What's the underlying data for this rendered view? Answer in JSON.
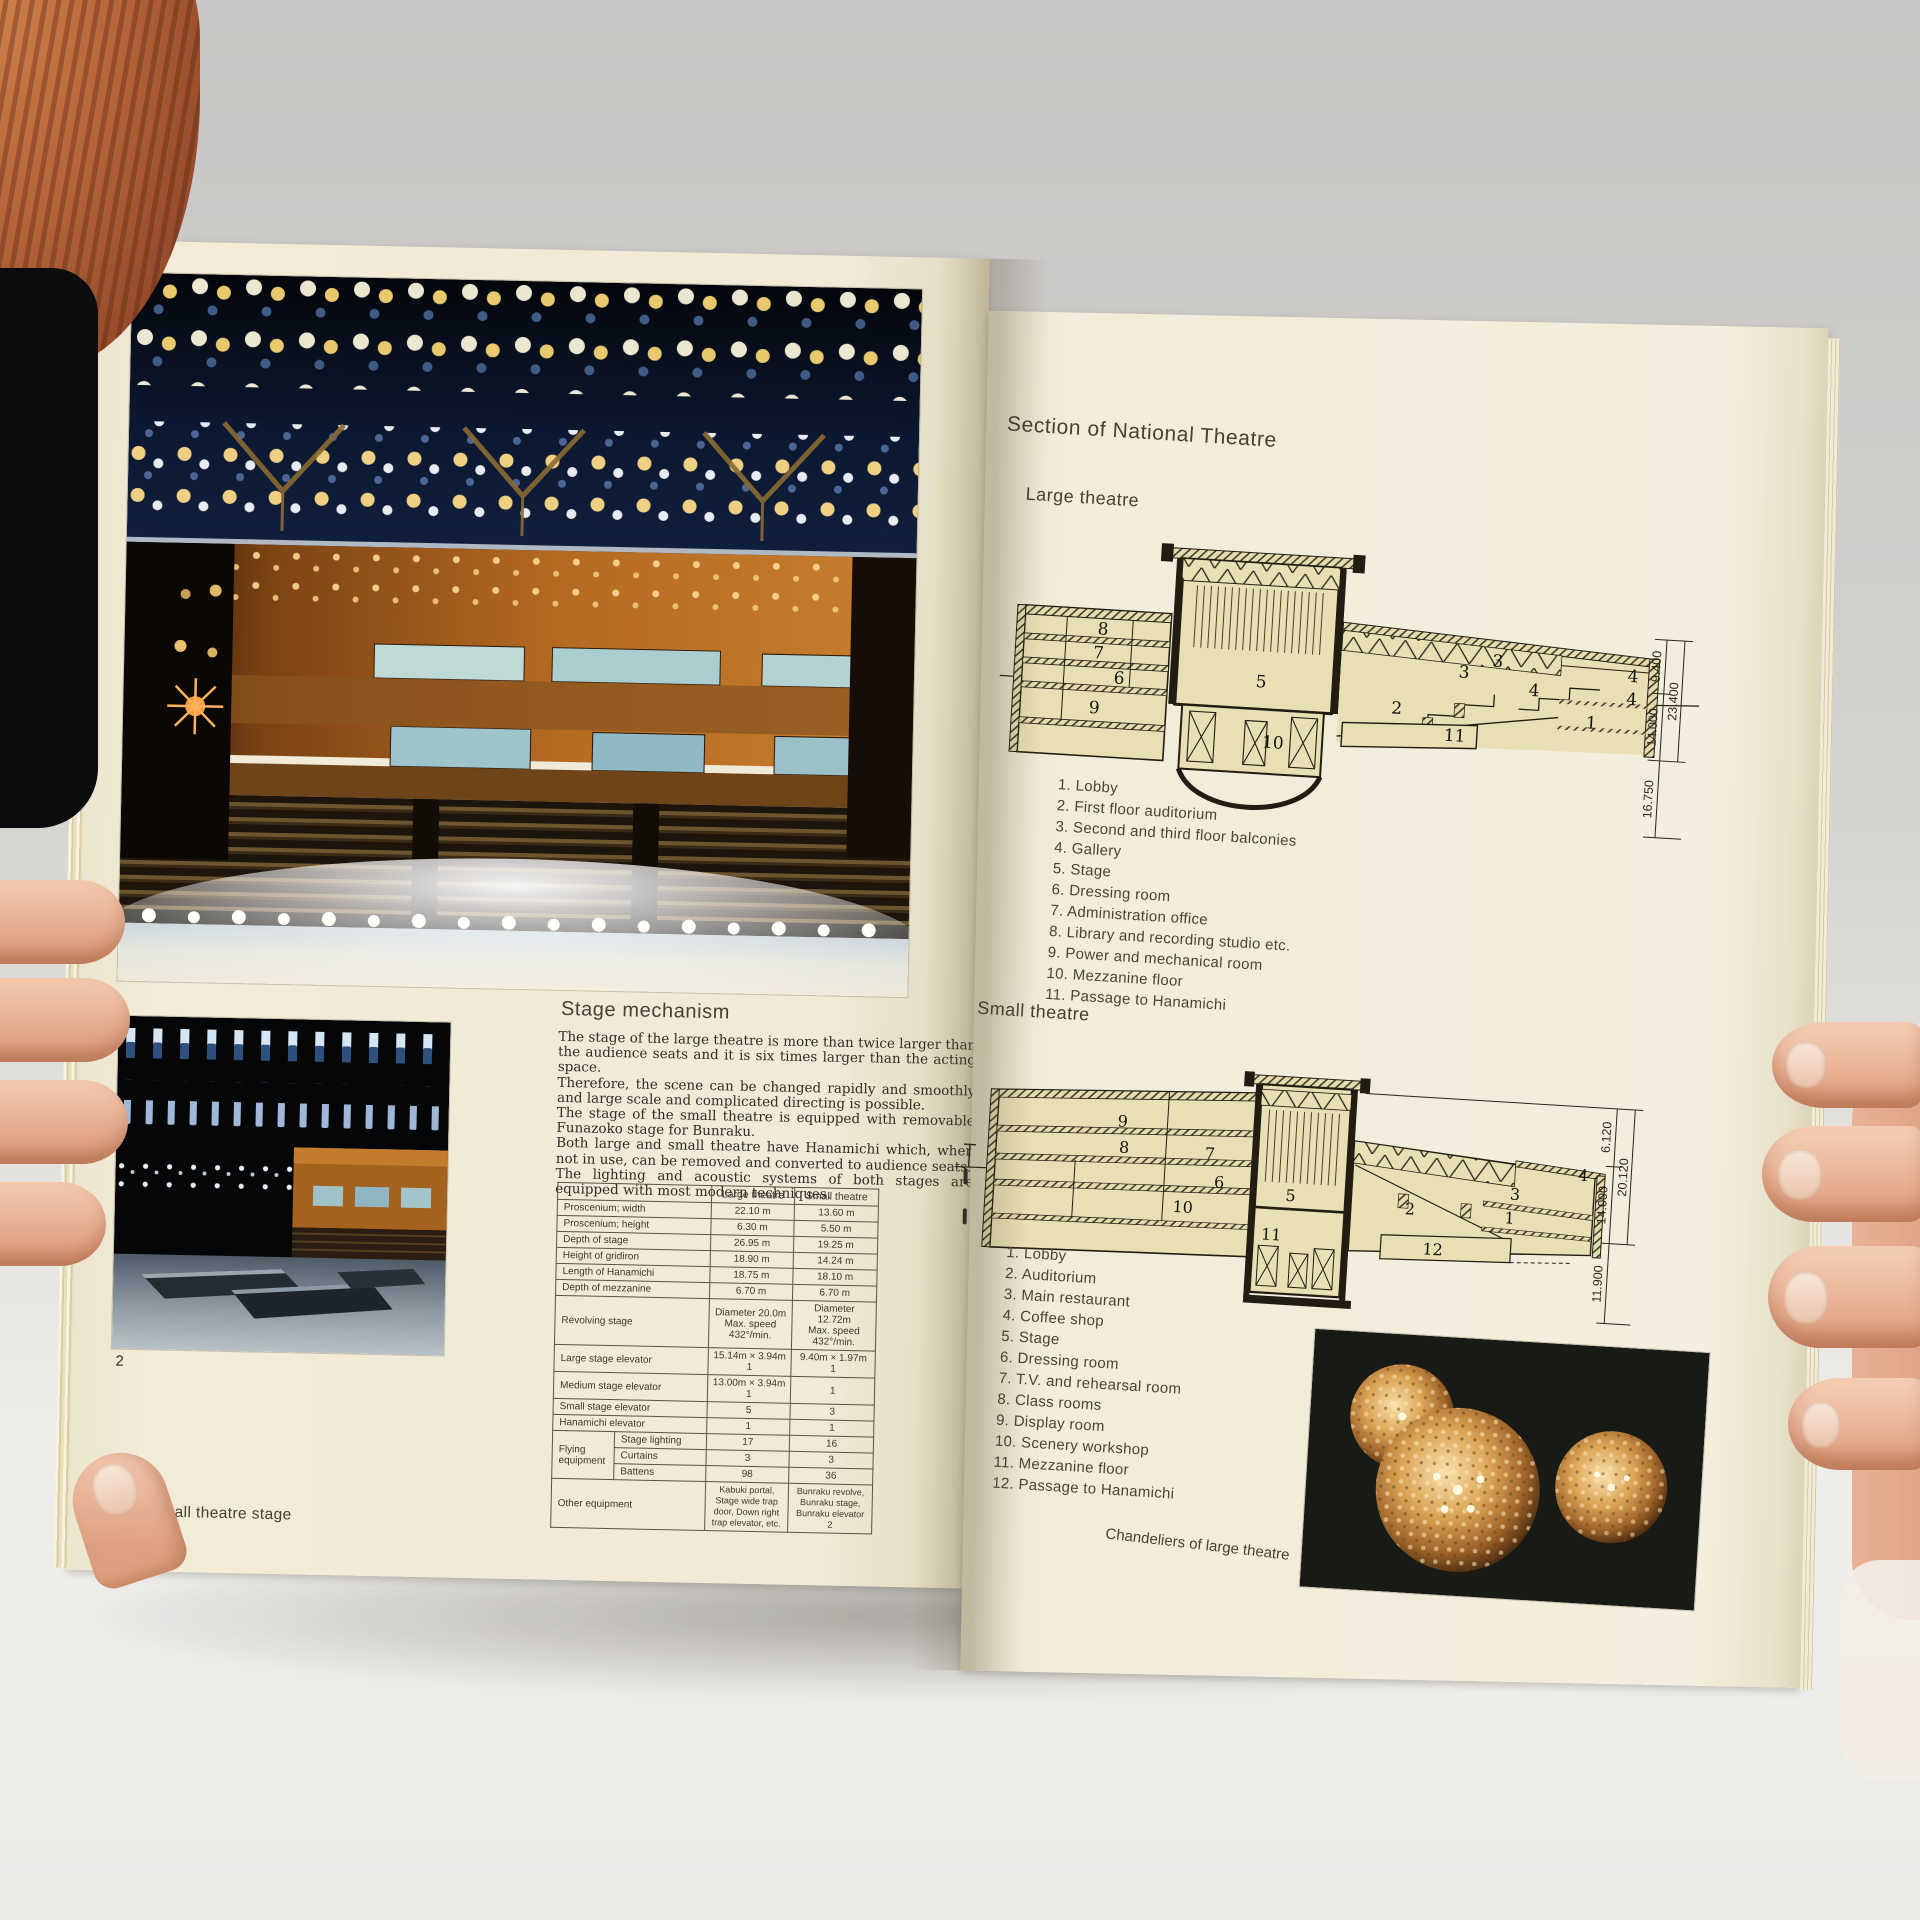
{
  "book": {
    "left_page": {
      "figure2_label": "2",
      "caption": "1.2. Small theatre stage",
      "stage_mechanism": {
        "heading": "Stage mechanism",
        "paragraphs": [
          "The stage of the large theatre is more than twice larger than the audience seats and it is six times larger than the acting space.",
          "Therefore, the scene can be changed rapidly and smoothly and large scale and complicated directing is possible.",
          "The stage of the small theatre is equipped with removable Funazoko stage for Bunraku.",
          "Both large and small theatre have Hanamichi which, when not in use, can be removed and converted to audience seats.",
          "The lighting and acoustic systems of both stages are equipped with most modern techniques."
        ]
      },
      "spec_table": {
        "col_large": "Large theatre",
        "col_small": "Small theatre",
        "rows": [
          {
            "label": "Proscenium; width",
            "large": "22.10 m",
            "small": "13.60 m"
          },
          {
            "label": "Proscenium; height",
            "large": "6.30 m",
            "small": "5.50 m"
          },
          {
            "label": "Depth of stage",
            "large": "26.95 m",
            "small": "19.25 m"
          },
          {
            "label": "Height of gridiron",
            "large": "18.90 m",
            "small": "14.24 m"
          },
          {
            "label": "Length of Hanamichi",
            "large": "18.75 m",
            "small": "18.10 m"
          },
          {
            "label": "Depth of mezzanine",
            "large": "6.70 m",
            "small": "6.70 m"
          },
          {
            "label": "Revolving stage",
            "large_l1": "Diameter 20.0m",
            "large_l2": "Max. speed 432°/min.",
            "small_l1": "Diameter 12.72m",
            "small_l2": "Max. speed 432°/min."
          },
          {
            "label": "Large stage elevator",
            "large_l1": "15.14m × 3.94m",
            "large_l2": "1",
            "small_l1": "9.40m × 1.97m",
            "small_l2": "1"
          },
          {
            "label": "Medium stage elevator",
            "large_l1": "13.00m × 3.94m",
            "large_l2": "1",
            "small": "1"
          },
          {
            "label": "Small stage elevator",
            "large": "5",
            "small": "3"
          },
          {
            "label": "Hanamichi elevator",
            "large": "1",
            "small": "1"
          },
          {
            "group": "Flying equipment",
            "sub": "Stage lighting",
            "large": "17",
            "small": "16"
          },
          {
            "sub": "Curtains",
            "large": "3",
            "small": "3"
          },
          {
            "sub": "Battens",
            "large": "98",
            "small": "36"
          },
          {
            "label": "Other equipment",
            "large": "Kabuki portal, Stage wide trap door, Down right trap elevator, etc.",
            "small": "Bunraku revolve, Bunraku stage, Bunraku elevator 2"
          }
        ]
      }
    },
    "right_page": {
      "title": "Section of National Theatre",
      "large_theatre": {
        "heading": "Large theatre",
        "legend": [
          "1. Lobby",
          "2. First floor auditorium",
          "3. Second and third floor balconies",
          "4. Gallery",
          "5. Stage",
          "6. Dressing room",
          "7. Administration office",
          "8. Library and recording studio etc.",
          "9. Power and mechanical room",
          "10. Mezzanine floor",
          "11. Passage to Hanamichi"
        ],
        "dims": {
          "top": "9.400",
          "mid": "14.000",
          "overall": "23.400",
          "bottom": "16.750"
        },
        "room_labels": [
          "8",
          "7",
          "6",
          "9",
          "5",
          "10",
          "2",
          "11",
          "3",
          "3",
          "4",
          "4",
          "4",
          "1"
        ]
      },
      "small_theatre": {
        "heading": "Small theatre",
        "legend": [
          "1. Lobby",
          "2. Auditorium",
          "3. Main restaurant",
          "4. Coffee shop",
          "5. Stage",
          "6. Dressing room",
          "7. T.V. and rehearsal room",
          "8. Class rooms",
          "9. Display room",
          "10. Scenery workshop",
          "11. Mezzanine floor",
          "12. Passage to Hanamichi"
        ],
        "dims": {
          "top": "6.120",
          "mid": "14.000",
          "overall": "20.120",
          "bottom": "11.900"
        },
        "room_labels": [
          "9",
          "8",
          "7",
          "6",
          "10",
          "5",
          "11",
          "2",
          "12",
          "3",
          "1",
          "4"
        ]
      },
      "chandeliers_caption": "Chandeliers of large theatre"
    },
    "colors": {
      "page_cream": "#f1ebd8",
      "drawing_fill": "#e9dfb4",
      "drawing_line": "#221d12",
      "photo_amber": "#c07a2a",
      "photo_blue": "#16335e",
      "chandelier_gold": "#d9a355"
    }
  }
}
